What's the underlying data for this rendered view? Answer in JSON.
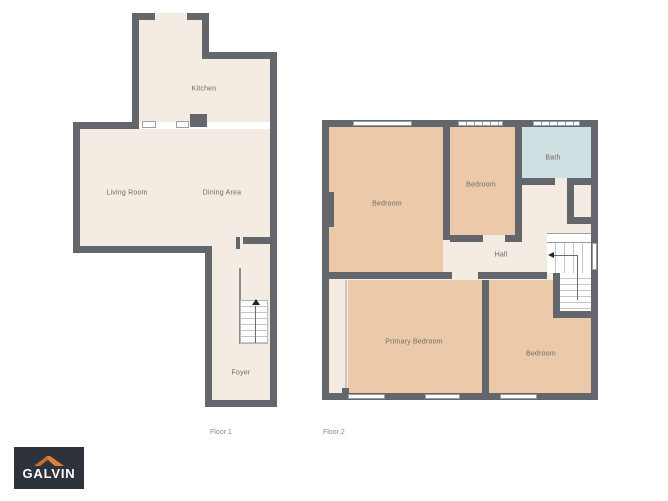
{
  "palette": {
    "background": "#ffffff",
    "wall": "#63666b",
    "thin_wall": "#c9c5bd",
    "floor": "#f4ece2",
    "room": "#eccaa9",
    "bath": "#cfe0e3",
    "label": "#6d6a62",
    "caption": "#85878a",
    "stair_line": "#c6c6c6",
    "window_border": "#9aa0a6",
    "logo_bg": "#2e333b",
    "logo_orange": "#e0813a",
    "logo_orange_dark": "#c96f2e"
  },
  "floors": [
    {
      "caption": "Floor 1",
      "rooms": [
        {
          "name": "Kitchen"
        },
        {
          "name": "Living Room"
        },
        {
          "name": "Dining Area"
        },
        {
          "name": "Foyer"
        }
      ]
    },
    {
      "caption": "Floor 2",
      "rooms": [
        {
          "name": "Bedroom"
        },
        {
          "name": "Bedroom"
        },
        {
          "name": "Bath"
        },
        {
          "name": "Hall"
        },
        {
          "name": "Primary Bedroom"
        },
        {
          "name": "Bedroom"
        }
      ]
    }
  ],
  "branding": {
    "logo_text": "GALVIN"
  }
}
